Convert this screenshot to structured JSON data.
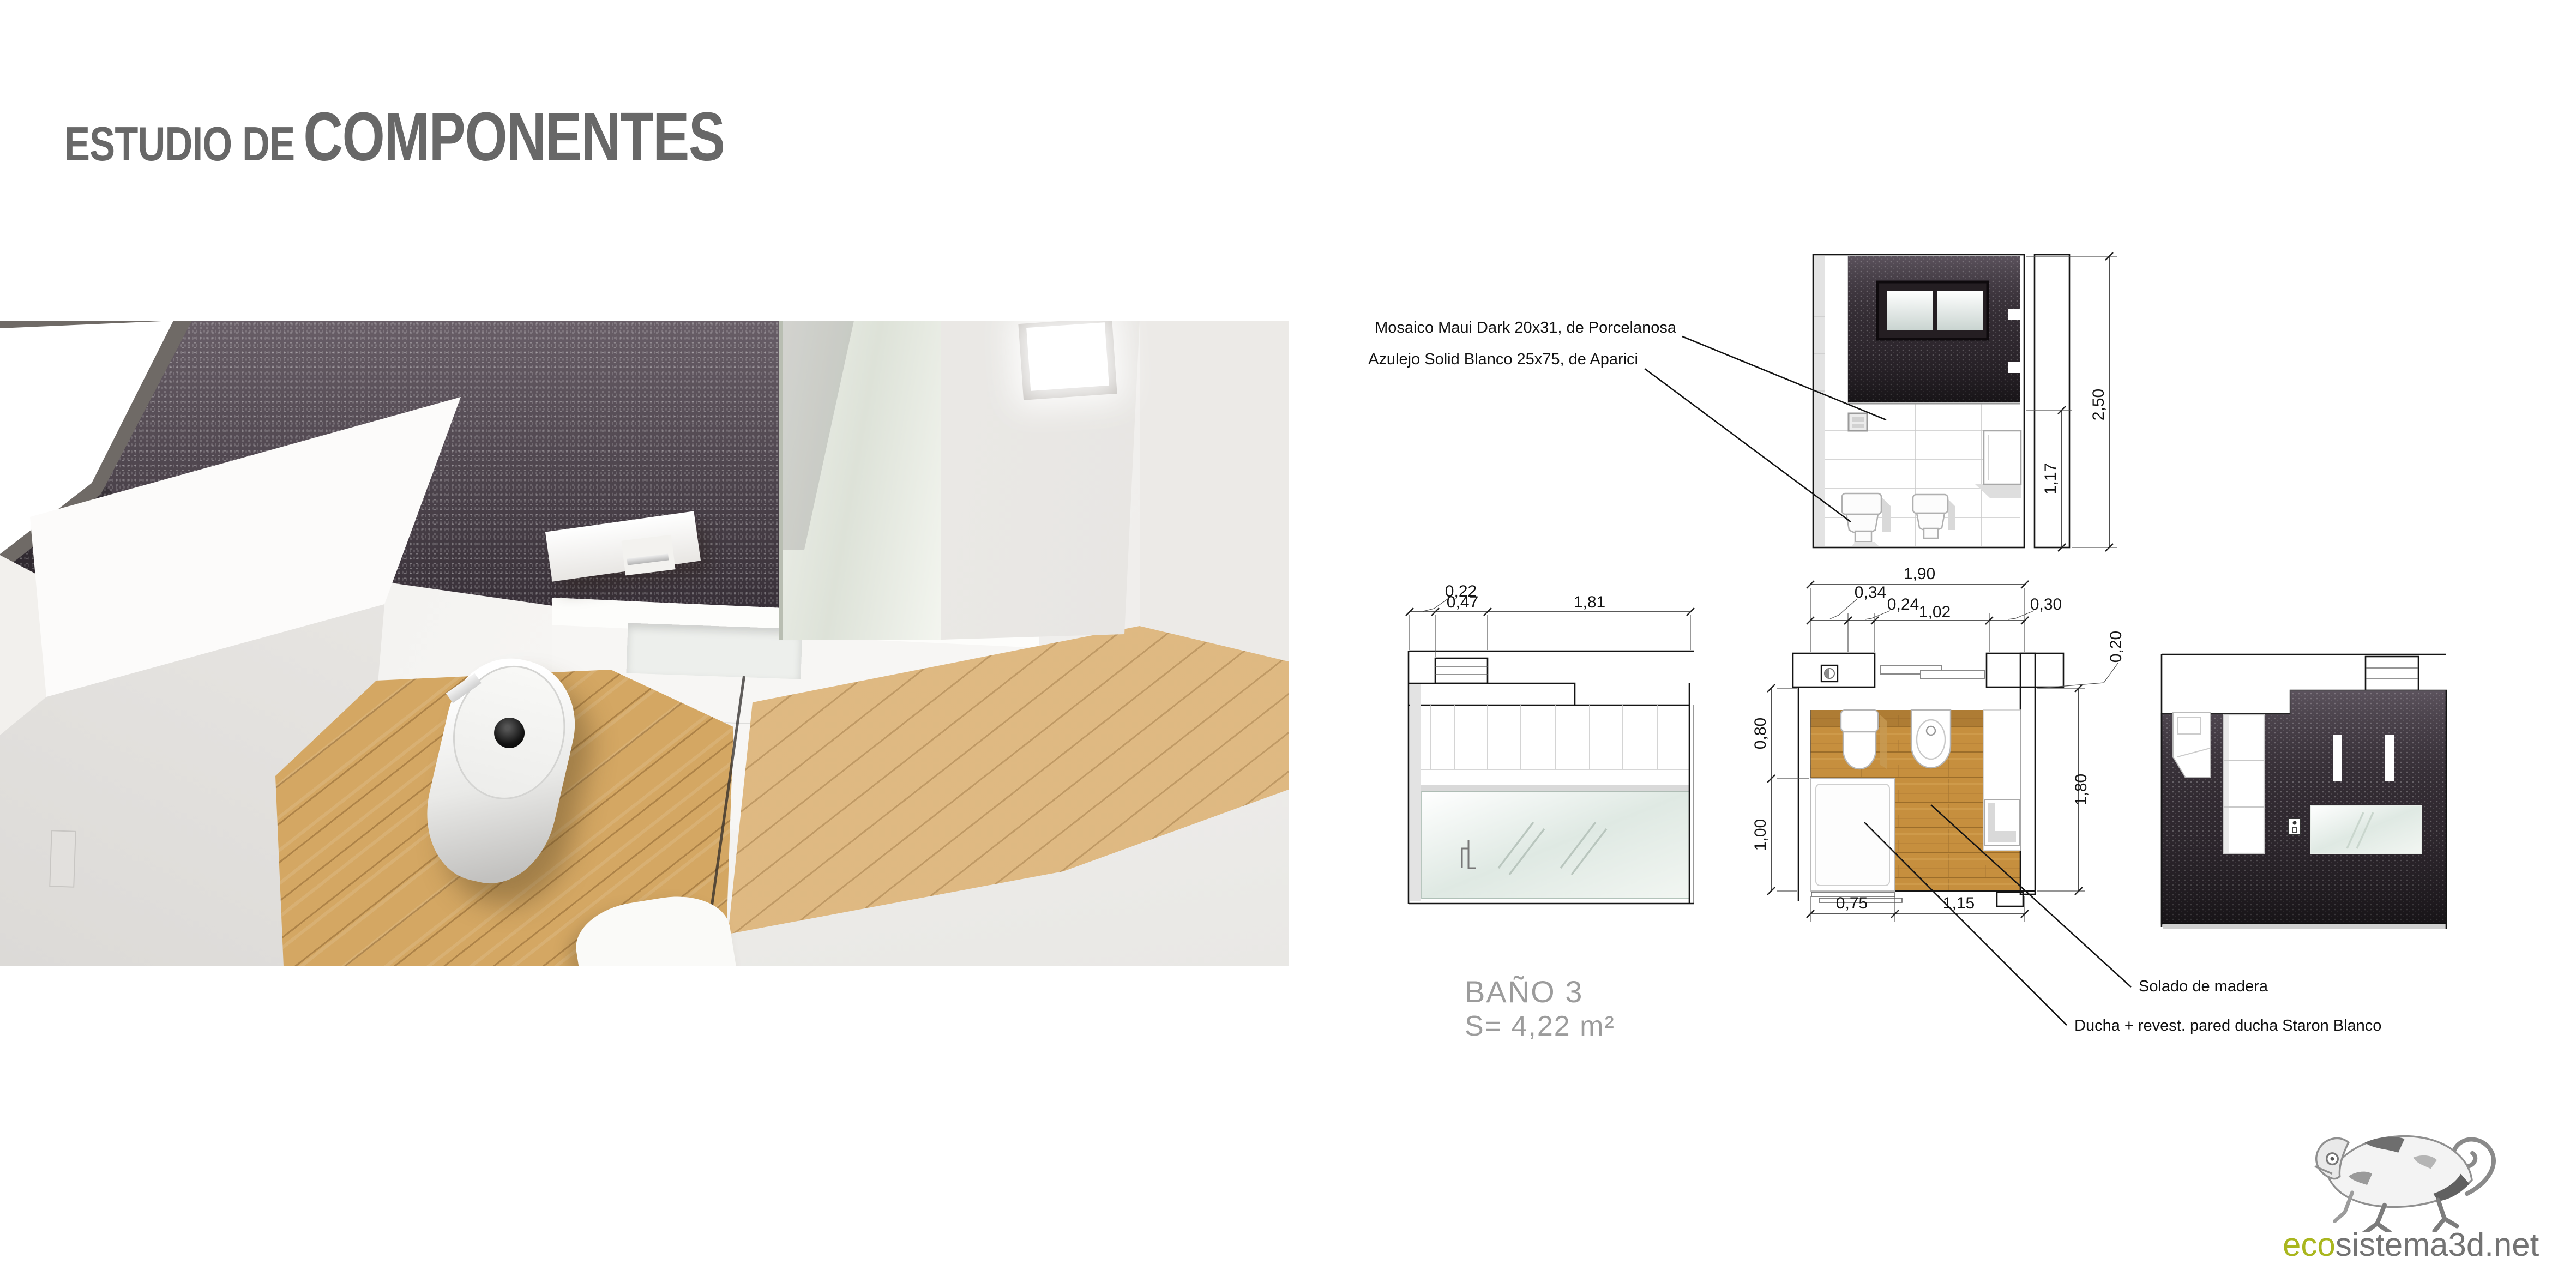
{
  "page": {
    "title_small": "ESTUDIO DE",
    "title_large": "COMPONENTES"
  },
  "annotations": {
    "mosaico": "Mosaico Maui Dark 20x31, de Porcelanosa",
    "azulejo": "Azulejo Solid Blanco 25x75, de Aparici",
    "solado": "Solado de madera",
    "ducha": "Ducha + revest. pared ducha Staron Blanco"
  },
  "room": {
    "name": "BAÑO 3",
    "area": "S= 4,22 m²"
  },
  "dimensions": {
    "front_elevation": {
      "total_height": "2,50",
      "tile_height": "1,17"
    },
    "side_elevation": {
      "d1": "0,22",
      "d2": "0,47",
      "d3": "1,81"
    },
    "plan": {
      "width_total": "1,90",
      "w1": "0,34",
      "w2": "0,24",
      "w3": "1,02",
      "w4": "0,30",
      "wall": "0,20",
      "depth_total": "1,80",
      "d_upper": "0,80",
      "d_lower": "1,00",
      "b1": "0,75",
      "b2": "1,15"
    }
  },
  "brand": {
    "logo_prefix": "eco",
    "logo_suffix": "sistema3d.net",
    "accent_green": "#a9b61e",
    "chameleon_icon": "chameleon-sketch"
  },
  "colors": {
    "title_gray": "#686868",
    "caption_gray": "#9c9c9c",
    "mosaic_dark": "#3c343c",
    "wood": "#c68f3e",
    "glass": "#dfe9e3"
  }
}
